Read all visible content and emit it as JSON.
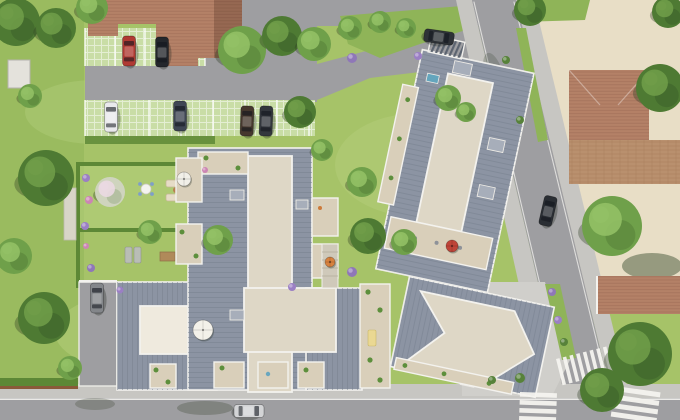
{
  "meta": {
    "canvas": {
      "width": 680,
      "height": 420
    }
  },
  "palette": {
    "lawn": "#a6c368",
    "lawn_light": "#b5cf7c",
    "lawn_dark": "#8fb458",
    "hedge": "#5d8836",
    "road": "#9e9ea1",
    "road_light": "#ababad",
    "sidewalk": "#c7c6c2",
    "plaza": "#d0cfcb",
    "pavers": "#c9dda6",
    "dirt": "#e8dec6",
    "brown_paving": "#b9906e",
    "terracotta": "#b48167",
    "roof": "#8c94a3",
    "roof_dark": "#7c8595",
    "flat_roof": "#ded7c6",
    "terrace": "#d9cfba",
    "patio": "#efeade",
    "white_trim": "#f3f2ee",
    "tree_dark": "#4e7a33",
    "tree_dark_hi": "#6f9c48",
    "tree_mid": "#6fa04a",
    "tree_mid_hi": "#92c065",
    "blossom": "#cfd4be",
    "blossom_hi": "#ead9e2",
    "shadow": "rgba(45,60,35,0.35)"
  },
  "scene": {
    "trees": [
      {
        "x": 16,
        "y": 22,
        "r": 24,
        "v": "dark"
      },
      {
        "x": 56,
        "y": 28,
        "r": 20,
        "v": "dark"
      },
      {
        "x": 92,
        "y": 8,
        "r": 16,
        "v": "mid"
      },
      {
        "x": 30,
        "y": 96,
        "r": 12,
        "v": "mid"
      },
      {
        "x": 46,
        "y": 178,
        "r": 28,
        "v": "dark"
      },
      {
        "x": 14,
        "y": 256,
        "r": 18,
        "v": "mid"
      },
      {
        "x": 44,
        "y": 318,
        "r": 26,
        "v": "dark"
      },
      {
        "x": 70,
        "y": 368,
        "r": 12,
        "v": "mid"
      },
      {
        "x": 242,
        "y": 50,
        "r": 24,
        "v": "mid"
      },
      {
        "x": 282,
        "y": 36,
        "r": 20,
        "v": "dark"
      },
      {
        "x": 314,
        "y": 44,
        "r": 17,
        "v": "mid"
      },
      {
        "x": 300,
        "y": 112,
        "r": 16,
        "v": "dark"
      },
      {
        "x": 350,
        "y": 28,
        "r": 12,
        "v": "mid"
      },
      {
        "x": 380,
        "y": 22,
        "r": 11,
        "v": "mid"
      },
      {
        "x": 406,
        "y": 28,
        "r": 10,
        "v": "mid"
      },
      {
        "x": 530,
        "y": 10,
        "r": 16,
        "v": "dark"
      },
      {
        "x": 668,
        "y": 12,
        "r": 16,
        "v": "dark"
      },
      {
        "x": 660,
        "y": 88,
        "r": 24,
        "v": "dark"
      },
      {
        "x": 612,
        "y": 226,
        "r": 30,
        "v": "mid"
      },
      {
        "x": 640,
        "y": 354,
        "r": 32,
        "v": "dark"
      },
      {
        "x": 602,
        "y": 390,
        "r": 22,
        "v": "dark"
      },
      {
        "x": 218,
        "y": 240,
        "r": 15,
        "v": "mid"
      },
      {
        "x": 110,
        "y": 192,
        "r": 15,
        "v": "blossom"
      },
      {
        "x": 150,
        "y": 232,
        "r": 12,
        "v": "mid"
      },
      {
        "x": 362,
        "y": 182,
        "r": 15,
        "v": "mid"
      },
      {
        "x": 368,
        "y": 236,
        "r": 18,
        "v": "dark"
      },
      {
        "x": 404,
        "y": 242,
        "r": 13,
        "v": "mid"
      },
      {
        "x": 322,
        "y": 150,
        "r": 11,
        "v": "mid"
      },
      {
        "x": 448,
        "y": 98,
        "r": 13,
        "v": "mid"
      },
      {
        "x": 466,
        "y": 112,
        "r": 10,
        "v": "mid"
      }
    ],
    "shrubs": [
      {
        "x": 86,
        "y": 178,
        "r": 4,
        "c": "#9b7fc4"
      },
      {
        "x": 89,
        "y": 200,
        "r": 4,
        "c": "#cc85b4"
      },
      {
        "x": 85,
        "y": 226,
        "r": 4,
        "c": "#9b7fc4"
      },
      {
        "x": 91,
        "y": 268,
        "r": 4,
        "c": "#8f77b8"
      },
      {
        "x": 86,
        "y": 246,
        "r": 3,
        "c": "#cc85b4"
      },
      {
        "x": 120,
        "y": 290,
        "r": 3.5,
        "c": "#9b7fc4"
      },
      {
        "x": 205,
        "y": 170,
        "r": 3,
        "c": "#cc85b4"
      },
      {
        "x": 352,
        "y": 58,
        "r": 5,
        "c": "#8f77b8"
      },
      {
        "x": 418,
        "y": 56,
        "r": 4,
        "c": "#9b7fc4"
      },
      {
        "x": 352,
        "y": 272,
        "r": 5,
        "c": "#8f77b8"
      },
      {
        "x": 292,
        "y": 287,
        "r": 4,
        "c": "#9b7fc4"
      },
      {
        "x": 552,
        "y": 292,
        "r": 4,
        "c": "#8f77b8"
      },
      {
        "x": 558,
        "y": 320,
        "r": 4,
        "c": "#9b7fc4"
      },
      {
        "x": 564,
        "y": 342,
        "r": 4,
        "c": "#57823a"
      },
      {
        "x": 506,
        "y": 60,
        "r": 4,
        "c": "#57823a"
      },
      {
        "x": 520,
        "y": 120,
        "r": 4,
        "c": "#57823a"
      },
      {
        "x": 520,
        "y": 378,
        "r": 5,
        "c": "#57823a"
      },
      {
        "x": 492,
        "y": 380,
        "r": 4,
        "c": "#57823a"
      }
    ],
    "cars": [
      {
        "x": 129,
        "y": 51,
        "rot": 0,
        "color": "#b03a33",
        "note": "red-car-parking"
      },
      {
        "x": 162,
        "y": 52,
        "rot": 0,
        "color": "#24272c",
        "note": "black-car-parking"
      },
      {
        "x": 111,
        "y": 117,
        "rot": 0,
        "color": "#e9e9ec",
        "note": "white-car-parking"
      },
      {
        "x": 180,
        "y": 116,
        "rot": 0,
        "color": "#3f4654",
        "note": "blue-gray-car-parking"
      },
      {
        "x": 247,
        "y": 121,
        "rot": 2,
        "color": "#46382e",
        "note": "brown-car-parking"
      },
      {
        "x": 266,
        "y": 121,
        "rot": 2,
        "color": "#33373d",
        "note": "dark-car-parking"
      },
      {
        "x": 439,
        "y": 37,
        "rot": 98,
        "color": "#2e3237",
        "note": "dark-car-driveway"
      },
      {
        "x": 548,
        "y": 211,
        "rot": 13,
        "color": "#2a2e34",
        "note": "dark-car-street"
      },
      {
        "x": 97,
        "y": 298,
        "rot": 0,
        "color": "#83868a",
        "note": "gray-car-lane"
      },
      {
        "x": 249,
        "y": 411,
        "rot": 90,
        "color": "#d3d4d6",
        "note": "silver-car-road"
      }
    ],
    "crosswalks": [
      {
        "x": 556,
        "y": 359,
        "rot": -14,
        "dir": "v",
        "n": 8,
        "w": 3.6,
        "len": 27,
        "gap": 6.9
      },
      {
        "x": 520,
        "y": 392,
        "rot": 2,
        "dir": "h",
        "n": 4,
        "w": 4.6,
        "len": 37,
        "gap": 8
      },
      {
        "x": 615,
        "y": 386,
        "rot": 8,
        "dir": "h",
        "n": 4,
        "w": 5,
        "len": 46,
        "gap": 8.6
      }
    ],
    "umbrellas": [
      {
        "x": 184,
        "y": 179,
        "r": 7,
        "c": "#f1efe8"
      },
      {
        "x": 203,
        "y": 330,
        "r": 10,
        "c": "#f3f1ea"
      },
      {
        "x": 452,
        "y": 246,
        "r": 6,
        "c": "#bf4438"
      },
      {
        "x": 330,
        "y": 262,
        "r": 5,
        "c": "#d8823f"
      }
    ]
  }
}
